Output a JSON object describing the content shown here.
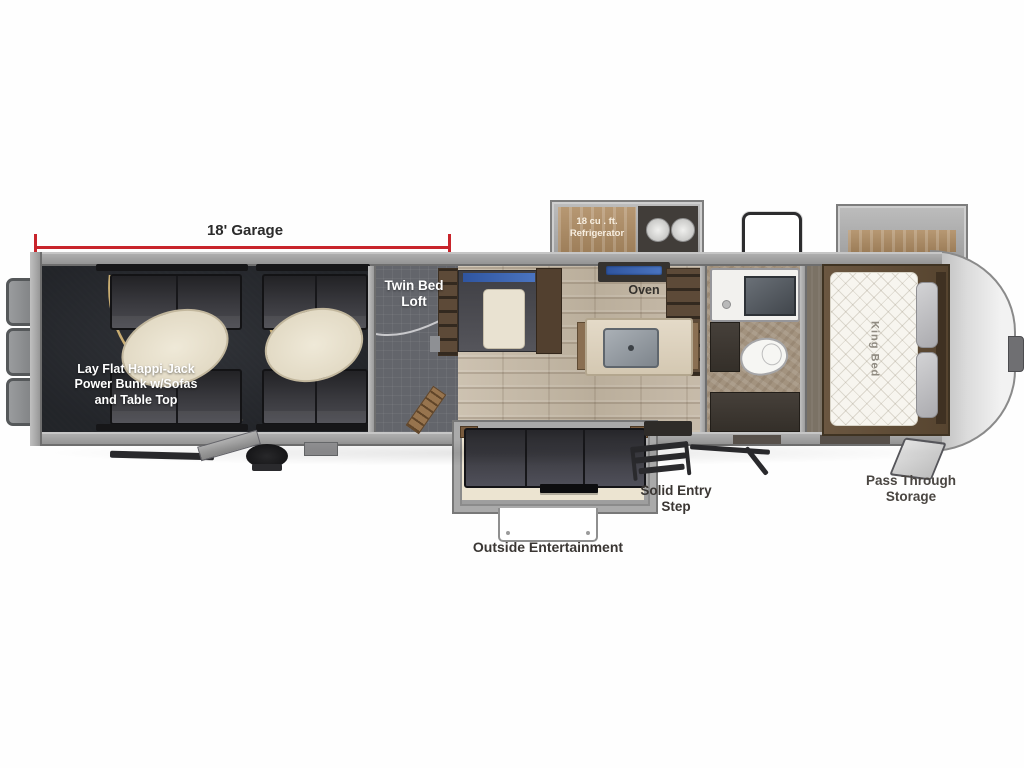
{
  "dimension": {
    "garage_length": "18' Garage"
  },
  "labels": {
    "garage_bunk": "Lay Flat Happi-Jack\nPower Bunk w/Sofas\nand Table Top",
    "twin_bed_loft": "Twin Bed\nLoft",
    "refrigerator": "18 cu . ft.\nRefrigerator",
    "oven": "Oven",
    "king_bed": "King Bed",
    "outside_entertainment": "Outside Entertainment",
    "solid_entry_step": "Solid Entry\nStep",
    "pass_through_storage": "Pass Through\nStorage"
  },
  "colors": {
    "dimension_line": "#c8242b",
    "wall_gray": "#9b9b9b",
    "garage_floor": "#47494d",
    "loft_floor": "#63656b",
    "wood_floor": "#c3b7a6",
    "sofa_dark": "#36363a",
    "island_cream": "#ded3c0",
    "cooktop_blue": "#3d66a8",
    "mattress_white": "#f7f5ef",
    "bunk_arc_tan": "#c9ad72"
  }
}
